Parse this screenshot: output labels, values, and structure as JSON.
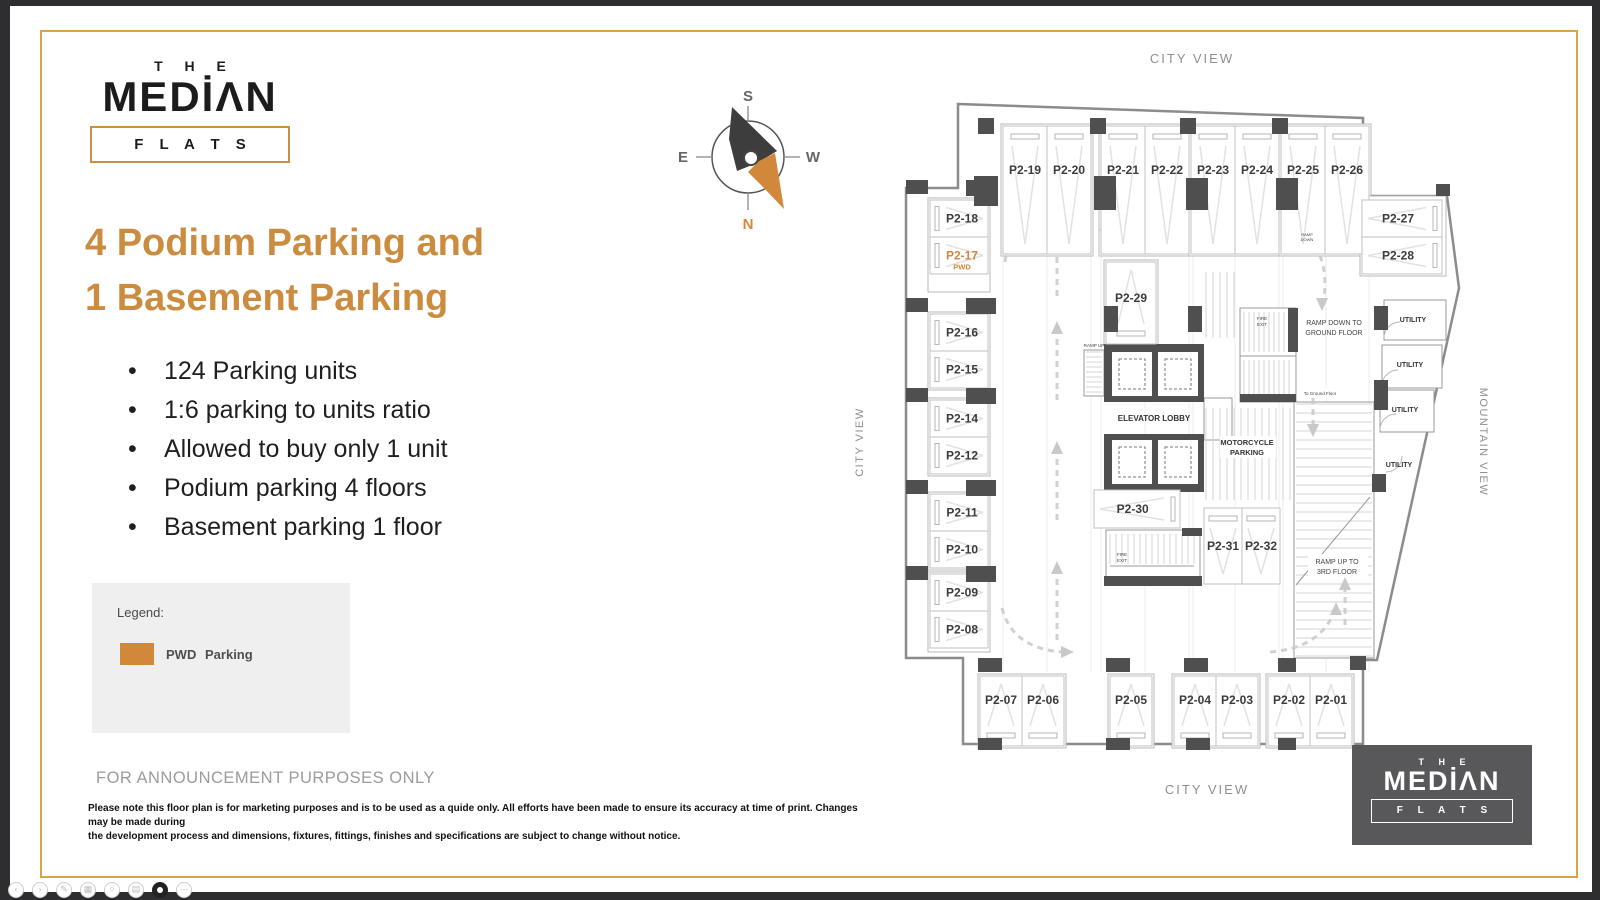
{
  "logo": {
    "the": "T H E",
    "median": "MEDİΛN",
    "flats": "F L A T S"
  },
  "headline": {
    "line1": "4 Podium Parking and",
    "line2": "1 Basement Parking",
    "color": "#CB8C3F"
  },
  "bullets": [
    "124 Parking units",
    "1:6 parking to units ratio",
    "Allowed to buy only 1 unit",
    "Podium parking 4 floors",
    "Basement parking 1 floor"
  ],
  "legend": {
    "title": "Legend:",
    "swatch_color": "#D2883B",
    "term": "PWD",
    "desc": "Parking"
  },
  "announcement": "FOR ANNOUNCEMENT PURPOSES ONLY",
  "disclaimer": {
    "line1": "Please note this floor plan is for marketing purposes and is to be used as a quide only. All efforts have been made to ensure its accuracy at time of print. Changes may be made during",
    "line2": "the development process and dimensions, fixtures, fittings, finishes and specifications are subject to change without notice."
  },
  "compass": {
    "labels": {
      "s": "S",
      "e": "E",
      "w": "W",
      "n": "N"
    },
    "north_color": "#D2883B",
    "needle_dark": "#3d3d3d"
  },
  "footer_logo": {
    "the": "T H E",
    "median": "MEDİΛN",
    "flats": "F L A T S",
    "bg": "#58585A"
  },
  "viewer_controls": [
    {
      "name": "back",
      "glyph": "‹"
    },
    {
      "name": "forward",
      "glyph": "›"
    },
    {
      "name": "edit",
      "glyph": "✎"
    },
    {
      "name": "grid",
      "glyph": "▦"
    },
    {
      "name": "zoom",
      "glyph": "○"
    },
    {
      "name": "print",
      "glyph": "▤"
    },
    {
      "name": "record",
      "glyph": "",
      "dark": true
    },
    {
      "name": "more",
      "glyph": "⋯"
    }
  ],
  "floorplan": {
    "wall_color": "#8c8c8c",
    "column_color": "#4f4f4f",
    "stall_line": "#c2c2c2",
    "label_color": "#3b3b3b",
    "pwd_color": "#D2883B",
    "outline": "M958,104 L1363,118 L1363,196 L1447,196 L1459,288 L1377,660 L1363,660 L1363,744 L963,744 L963,658 L906,658 L906,188 L958,188 Z",
    "grid_x": [
      1003,
      1047,
      1091,
      1101,
      1145,
      1189,
      1193,
      1235,
      1279,
      1283,
      1326,
      1369
    ],
    "grid_y1": 256,
    "grid_y2": 672,
    "group_boxes": [
      [
        1001,
        124,
        92,
        132
      ],
      [
        1099,
        124,
        92,
        132
      ],
      [
        1189,
        124,
        92,
        132
      ],
      [
        1279,
        124,
        92,
        132
      ],
      [
        928,
        198,
        62,
        94
      ],
      [
        928,
        312,
        62,
        78
      ],
      [
        928,
        398,
        62,
        78
      ],
      [
        928,
        492,
        62,
        78
      ],
      [
        928,
        572,
        62,
        80
      ],
      [
        978,
        674,
        88,
        74
      ],
      [
        1108,
        674,
        46,
        74
      ],
      [
        1172,
        674,
        88,
        74
      ],
      [
        1266,
        674,
        88,
        74
      ],
      [
        1360,
        196,
        86,
        80
      ],
      [
        1104,
        260,
        54,
        86
      ]
    ],
    "stalls": [
      {
        "label": "P2-19",
        "x": 1003,
        "y": 126,
        "w": 44,
        "h": 128,
        "o": "vt"
      },
      {
        "label": "P2-20",
        "x": 1047,
        "y": 126,
        "w": 44,
        "h": 128,
        "o": "vt"
      },
      {
        "label": "P2-21",
        "x": 1101,
        "y": 126,
        "w": 44,
        "h": 128,
        "o": "vt"
      },
      {
        "label": "P2-22",
        "x": 1145,
        "y": 126,
        "w": 44,
        "h": 128,
        "o": "vt"
      },
      {
        "label": "P2-23",
        "x": 1191,
        "y": 126,
        "w": 44,
        "h": 128,
        "o": "vt"
      },
      {
        "label": "P2-24",
        "x": 1235,
        "y": 126,
        "w": 44,
        "h": 128,
        "o": "vt"
      },
      {
        "label": "P2-25",
        "x": 1281,
        "y": 126,
        "w": 44,
        "h": 128,
        "o": "vt"
      },
      {
        "label": "P2-26",
        "x": 1325,
        "y": 126,
        "w": 44,
        "h": 128,
        "o": "vt"
      },
      {
        "label": "P2-18",
        "x": 930,
        "y": 200,
        "w": 58,
        "h": 37,
        "o": "hl"
      },
      {
        "label": "P2-17",
        "x": 930,
        "y": 237,
        "w": 58,
        "h": 37,
        "o": "hl",
        "pwd": true,
        "sub": "PWD"
      },
      {
        "label": "P2-16",
        "x": 930,
        "y": 314,
        "w": 58,
        "h": 37,
        "o": "hl"
      },
      {
        "label": "P2-15",
        "x": 930,
        "y": 351,
        "w": 58,
        "h": 37,
        "o": "hl"
      },
      {
        "label": "P2-14",
        "x": 930,
        "y": 400,
        "w": 58,
        "h": 37,
        "o": "hl"
      },
      {
        "label": "P2-12",
        "x": 930,
        "y": 437,
        "w": 58,
        "h": 37,
        "o": "hl"
      },
      {
        "label": "P2-11",
        "x": 930,
        "y": 494,
        "w": 58,
        "h": 37,
        "o": "hl"
      },
      {
        "label": "P2-10",
        "x": 930,
        "y": 531,
        "w": 58,
        "h": 37,
        "o": "hl"
      },
      {
        "label": "P2-09",
        "x": 930,
        "y": 574,
        "w": 58,
        "h": 37,
        "o": "hl"
      },
      {
        "label": "P2-08",
        "x": 930,
        "y": 611,
        "w": 58,
        "h": 37,
        "o": "hl"
      },
      {
        "label": "P2-27",
        "x": 1362,
        "y": 200,
        "w": 80,
        "h": 37,
        "o": "hr"
      },
      {
        "label": "P2-28",
        "x": 1362,
        "y": 237,
        "w": 80,
        "h": 37,
        "o": "hr"
      },
      {
        "label": "P2-29",
        "x": 1106,
        "y": 262,
        "w": 50,
        "h": 82,
        "o": "vb"
      },
      {
        "label": "P2-30",
        "x": 1094,
        "y": 490,
        "w": 86,
        "h": 38,
        "o": "hr"
      },
      {
        "label": "P2-31",
        "x": 1204,
        "y": 508,
        "w": 38,
        "h": 76,
        "o": "vt"
      },
      {
        "label": "P2-32",
        "x": 1242,
        "y": 508,
        "w": 38,
        "h": 76,
        "o": "vt"
      },
      {
        "label": "P2-07",
        "x": 980,
        "y": 676,
        "w": 42,
        "h": 70,
        "o": "vb"
      },
      {
        "label": "P2-06",
        "x": 1022,
        "y": 676,
        "w": 42,
        "h": 70,
        "o": "vb"
      },
      {
        "label": "P2-05",
        "x": 1110,
        "y": 676,
        "w": 42,
        "h": 70,
        "o": "vb"
      },
      {
        "label": "P2-04",
        "x": 1174,
        "y": 676,
        "w": 42,
        "h": 70,
        "o": "vb"
      },
      {
        "label": "P2-03",
        "x": 1216,
        "y": 676,
        "w": 42,
        "h": 70,
        "o": "vb"
      },
      {
        "label": "P2-02",
        "x": 1268,
        "y": 676,
        "w": 42,
        "h": 70,
        "o": "vb"
      },
      {
        "label": "P2-01",
        "x": 1310,
        "y": 676,
        "w": 42,
        "h": 70,
        "o": "vb"
      }
    ],
    "columns": [
      [
        978,
        118,
        16,
        16
      ],
      [
        1090,
        118,
        16,
        16
      ],
      [
        1180,
        118,
        16,
        16
      ],
      [
        1272,
        118,
        16,
        16
      ],
      [
        974,
        176,
        24,
        30
      ],
      [
        1094,
        176,
        22,
        34
      ],
      [
        1186,
        178,
        22,
        32
      ],
      [
        1276,
        178,
        22,
        32
      ],
      [
        906,
        180,
        22,
        14
      ],
      [
        966,
        180,
        26,
        16
      ],
      [
        906,
        298,
        22,
        14
      ],
      [
        966,
        298,
        30,
        16
      ],
      [
        906,
        388,
        22,
        14
      ],
      [
        966,
        388,
        30,
        16
      ],
      [
        906,
        480,
        22,
        14
      ],
      [
        966,
        480,
        30,
        16
      ],
      [
        906,
        566,
        22,
        14
      ],
      [
        966,
        566,
        30,
        16
      ],
      [
        978,
        658,
        24,
        14
      ],
      [
        1106,
        658,
        24,
        14
      ],
      [
        1184,
        658,
        24,
        14
      ],
      [
        1278,
        658,
        18,
        14
      ],
      [
        1350,
        656,
        16,
        14
      ],
      [
        978,
        738,
        24,
        12
      ],
      [
        1106,
        738,
        24,
        12
      ],
      [
        1186,
        738,
        24,
        12
      ],
      [
        1278,
        738,
        18,
        12
      ],
      [
        1104,
        306,
        14,
        26
      ],
      [
        1188,
        306,
        14,
        26
      ],
      [
        1374,
        306,
        14,
        24
      ],
      [
        1374,
        380,
        14,
        30
      ],
      [
        1372,
        474,
        14,
        18
      ],
      [
        1436,
        184,
        14,
        12
      ]
    ],
    "outline_rects": [
      [
        1294,
        402,
        80,
        256
      ],
      [
        1240,
        308,
        56,
        94
      ],
      [
        1106,
        530,
        94,
        54
      ],
      [
        1084,
        350,
        20,
        46
      ],
      [
        1204,
        398,
        28,
        42
      ],
      [
        1384,
        300,
        62,
        40
      ],
      [
        1382,
        345,
        60,
        43
      ],
      [
        1380,
        390,
        54,
        42
      ]
    ],
    "hatches": [
      {
        "d": "v",
        "x": 1244,
        "y": 312,
        "w": 48,
        "h": 40,
        "s": 5
      },
      {
        "d": "v",
        "x": 1244,
        "y": 360,
        "w": 48,
        "h": 36,
        "s": 5
      },
      {
        "d": "v",
        "x": 1110,
        "y": 534,
        "w": 84,
        "h": 30,
        "s": 6
      },
      {
        "d": "h",
        "x": 1086,
        "y": 352,
        "w": 16,
        "h": 42,
        "s": 5
      },
      {
        "d": "h",
        "x": 1296,
        "y": 404,
        "w": 76,
        "h": 252,
        "s": 9
      },
      {
        "d": "v",
        "x": 1206,
        "y": 408,
        "w": 84,
        "h": 92,
        "s": 7
      },
      {
        "d": "v",
        "x": 1206,
        "y": 272,
        "w": 32,
        "h": 66,
        "s": 7
      }
    ],
    "lines": [
      [
        1110,
        566,
        1194,
        566
      ],
      [
        1240,
        356,
        1296,
        356
      ],
      [
        1296,
        585,
        1370,
        497
      ]
    ],
    "filled": [
      [
        1104,
        344,
        100,
        58
      ],
      [
        1104,
        434,
        100,
        58
      ],
      [
        1104,
        576,
        98,
        10
      ],
      [
        1182,
        528,
        20,
        8
      ],
      [
        1288,
        308,
        10,
        44
      ],
      [
        1240,
        394,
        56,
        8
      ]
    ],
    "white_rects": [
      [
        1112,
        352,
        40,
        44
      ],
      [
        1158,
        352,
        40,
        44
      ],
      [
        1112,
        440,
        40,
        44
      ],
      [
        1158,
        440,
        40,
        44
      ],
      [
        1220,
        436,
        56,
        22
      ],
      [
        1308,
        554,
        60,
        24
      ],
      [
        1300,
        388,
        44,
        10
      ]
    ],
    "cab_rects": [
      [
        1119,
        359,
        26,
        30
      ],
      [
        1165,
        359,
        26,
        30
      ],
      [
        1119,
        447,
        26,
        30
      ],
      [
        1165,
        447,
        26,
        30
      ]
    ],
    "dashes": [
      "M1057,640 L1057,572",
      "M1057,520 L1057,452",
      "M1057,400 L1057,332",
      "M1057,296 L1057,252",
      "M1265,230 L1110,230",
      "M1298,232 Q1330,248 1324,300",
      "M1002,608 Q1012,648 1062,652",
      "M1270,652 Q1320,648 1334,612",
      "M1005,262 Q1008,232 1040,228",
      "M1313,398 L1313,426",
      "M1345,625 L1345,588"
    ],
    "arrows": [
      [
        1057,
        565,
        "u"
      ],
      [
        1057,
        445,
        "u"
      ],
      [
        1057,
        325,
        "u"
      ],
      [
        1057,
        245,
        "u"
      ],
      [
        1103,
        230,
        "l"
      ],
      [
        1322,
        307,
        "d"
      ],
      [
        1070,
        652,
        "r"
      ],
      [
        1336,
        606,
        "u"
      ],
      [
        1048,
        228,
        "r"
      ],
      [
        1313,
        433,
        "d"
      ],
      [
        1345,
        581,
        "u"
      ]
    ],
    "arcs": [
      "M1384,338 A16,16 0 0 1 1400,322",
      "M1382,386 A16,16 0 0 1 1398,370",
      "M1380,430 A16,16 0 0 1 1396,414",
      "M1386,472 A16,16 0 0 0 1402,456"
    ],
    "circle": {
      "cx": 1292,
      "cy": 238,
      "r": 5
    },
    "texts": [
      {
        "t": "CITY VIEW",
        "x": 1192,
        "y": 63,
        "s": 13,
        "c": "#8f8f8f",
        "ls": 2
      },
      {
        "t": "CITY VIEW",
        "x": 1207,
        "y": 794,
        "s": 13,
        "c": "#8f8f8f",
        "ls": 2
      },
      {
        "t": "CITY VIEW",
        "x": 863,
        "y": 442,
        "s": 11,
        "c": "#8f8f8f",
        "ls": 1.5,
        "rot": -90
      },
      {
        "t": "MOUNTAIN VIEW",
        "x": 1480,
        "y": 442,
        "s": 11,
        "c": "#8f8f8f",
        "ls": 1.5,
        "rot": 90
      },
      {
        "t": "ELEVATOR LOBBY",
        "x": 1154,
        "y": 421,
        "s": 8,
        "c": "#333",
        "b": true
      },
      {
        "t": "MOTORCYCLE",
        "x": 1247,
        "y": 445,
        "s": 7.5,
        "c": "#333",
        "b": true
      },
      {
        "t": "PARKING",
        "x": 1247,
        "y": 455,
        "s": 7.5,
        "c": "#333",
        "b": true
      },
      {
        "t": "RAMP DOWN TO",
        "x": 1334,
        "y": 325,
        "s": 7,
        "c": "#444"
      },
      {
        "t": "GROUND FLOOR",
        "x": 1334,
        "y": 335,
        "s": 7,
        "c": "#444"
      },
      {
        "t": "RAMP UP TO",
        "x": 1337,
        "y": 564,
        "s": 7,
        "c": "#444"
      },
      {
        "t": "3RD FLOOR",
        "x": 1337,
        "y": 574,
        "s": 7,
        "c": "#444"
      },
      {
        "t": "UTILITY",
        "x": 1413,
        "y": 322,
        "s": 7,
        "c": "#333",
        "b": true
      },
      {
        "t": "UTILITY",
        "x": 1410,
        "y": 367,
        "s": 7,
        "c": "#333",
        "b": true
      },
      {
        "t": "UTILITY",
        "x": 1405,
        "y": 412,
        "s": 7,
        "c": "#333",
        "b": true
      },
      {
        "t": "UTILITY",
        "x": 1399,
        "y": 467,
        "s": 7,
        "c": "#333",
        "b": true
      },
      {
        "t": "FIRE",
        "x": 1262,
        "y": 320,
        "s": 4.5,
        "c": "#444"
      },
      {
        "t": "EXIT",
        "x": 1262,
        "y": 326,
        "s": 4.5,
        "c": "#444"
      },
      {
        "t": "FIRE",
        "x": 1122,
        "y": 556,
        "s": 4.5,
        "c": "#444"
      },
      {
        "t": "EXIT",
        "x": 1122,
        "y": 562,
        "s": 4.5,
        "c": "#444"
      },
      {
        "t": "RAMP UP",
        "x": 1094,
        "y": 347,
        "s": 4.5,
        "c": "#444"
      },
      {
        "t": "RAMP",
        "x": 1307,
        "y": 236,
        "s": 4,
        "c": "#444"
      },
      {
        "t": "DOWN",
        "x": 1307,
        "y": 241,
        "s": 4,
        "c": "#444"
      },
      {
        "t": "To Ground Floor",
        "x": 1320,
        "y": 395,
        "s": 4.5,
        "c": "#444"
      }
    ]
  }
}
